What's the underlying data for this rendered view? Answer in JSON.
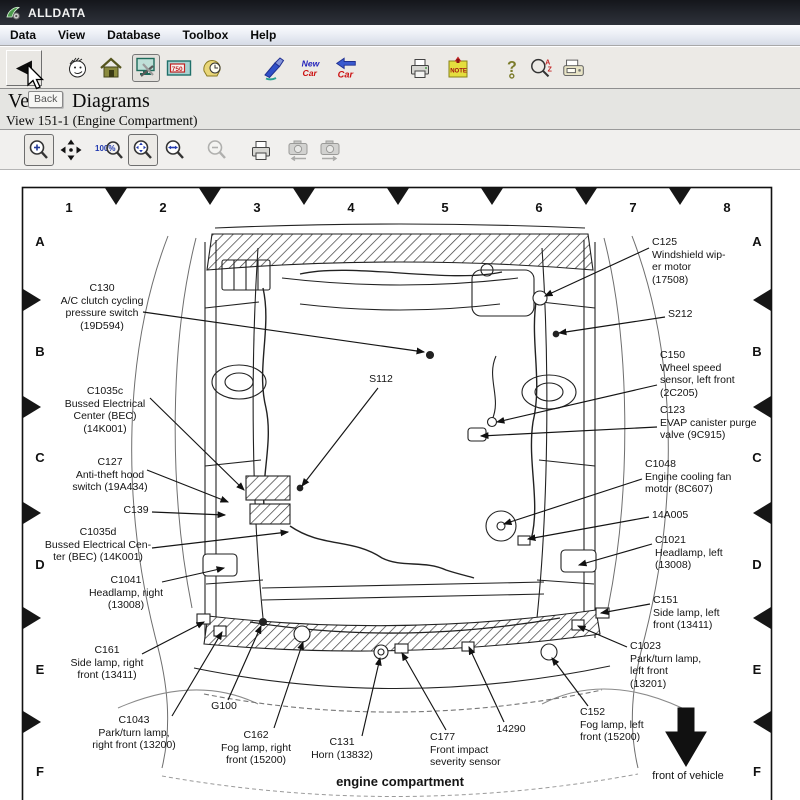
{
  "window": {
    "title": "ALLDATA"
  },
  "menu": {
    "items": [
      "Data",
      "View",
      "Database",
      "Toolbox",
      "Help"
    ]
  },
  "toolbar": {
    "tooltip": "Back",
    "icons": [
      "back",
      "contact-face",
      "home",
      "diagrams-tools",
      "gauge-750",
      "hand-clock",
      "wash-brush",
      "new-car",
      "return-car",
      "print",
      "note",
      "help-key",
      "search-az",
      "fax"
    ],
    "gauge_text": "750",
    "note_text": "NOTE",
    "new_car_line1": "New",
    "new_car_line2": "Car",
    "return_car_text": "Car",
    "help_text": "?",
    "search_a": "A",
    "search_z": "Z"
  },
  "page": {
    "title_prefix": "Ve",
    "title": "Diagrams",
    "subtitle": "View 151-1 (Engine Compartment)"
  },
  "zoombar": {
    "icons": [
      "zoom-in",
      "pan",
      "zoom-100",
      "zoom-fit",
      "zoom-width",
      "zoom-out",
      "print",
      "view-previous",
      "view-next"
    ],
    "zoom100_text": "100%"
  },
  "diagram": {
    "cols": [
      "1",
      "2",
      "3",
      "4",
      "5",
      "6",
      "7",
      "8"
    ],
    "rows": [
      "A",
      "B",
      "C",
      "D",
      "E",
      "F"
    ],
    "caption": "engine compartment",
    "front_label": "front of vehicle",
    "labels": [
      {
        "id": "C130",
        "text": "C130\nA/C clutch cycling\npressure switch\n(19D594)"
      },
      {
        "id": "C1035c",
        "text": "C1035c\nBussed Electrical\nCenter (BEC)\n(14K001)"
      },
      {
        "id": "C127",
        "text": "C127\nAnti-theft hood\nswitch (19A434)"
      },
      {
        "id": "C139",
        "text": "C139"
      },
      {
        "id": "C1035d",
        "text": "C1035d\nBussed Electrical Cen-\nter (BEC) (14K001)"
      },
      {
        "id": "C1041",
        "text": "C1041\nHeadlamp, right\n(13008)"
      },
      {
        "id": "C161",
        "text": "C161\nSide lamp, right\nfront (13411)"
      },
      {
        "id": "C1043",
        "text": "C1043\nPark/turn lamp,\nright front (13200)"
      },
      {
        "id": "G100",
        "text": "G100"
      },
      {
        "id": "C162",
        "text": "C162\nFog lamp, right\nfront (15200)"
      },
      {
        "id": "C131",
        "text": "C131\nHorn (13832)"
      },
      {
        "id": "C177",
        "text": "C177\nFront impact\nseverity sensor"
      },
      {
        "id": "14290",
        "text": "14290"
      },
      {
        "id": "C152",
        "text": "C152\nFog lamp, left\nfront (15200)"
      },
      {
        "id": "S112",
        "text": "S112"
      },
      {
        "id": "C125",
        "text": "C125\nWindshield wip-\ner motor\n(17508)"
      },
      {
        "id": "S212",
        "text": "S212"
      },
      {
        "id": "C150",
        "text": "C150\nWheel speed\nsensor, left front\n(2C205)"
      },
      {
        "id": "C123",
        "text": "C123\nEVAP canister purge\nvalve (9C915)"
      },
      {
        "id": "C1048",
        "text": "C1048\nEngine cooling fan\nmotor (8C607)"
      },
      {
        "id": "14A005",
        "text": "14A005"
      },
      {
        "id": "C1021",
        "text": "C1021\nHeadlamp, left\n(13008)"
      },
      {
        "id": "C151",
        "text": "C151\nSide lamp, left\nfront (13411)"
      },
      {
        "id": "C1023",
        "text": "C1023\nPark/turn lamp,\nleft front\n(13201)"
      }
    ]
  }
}
